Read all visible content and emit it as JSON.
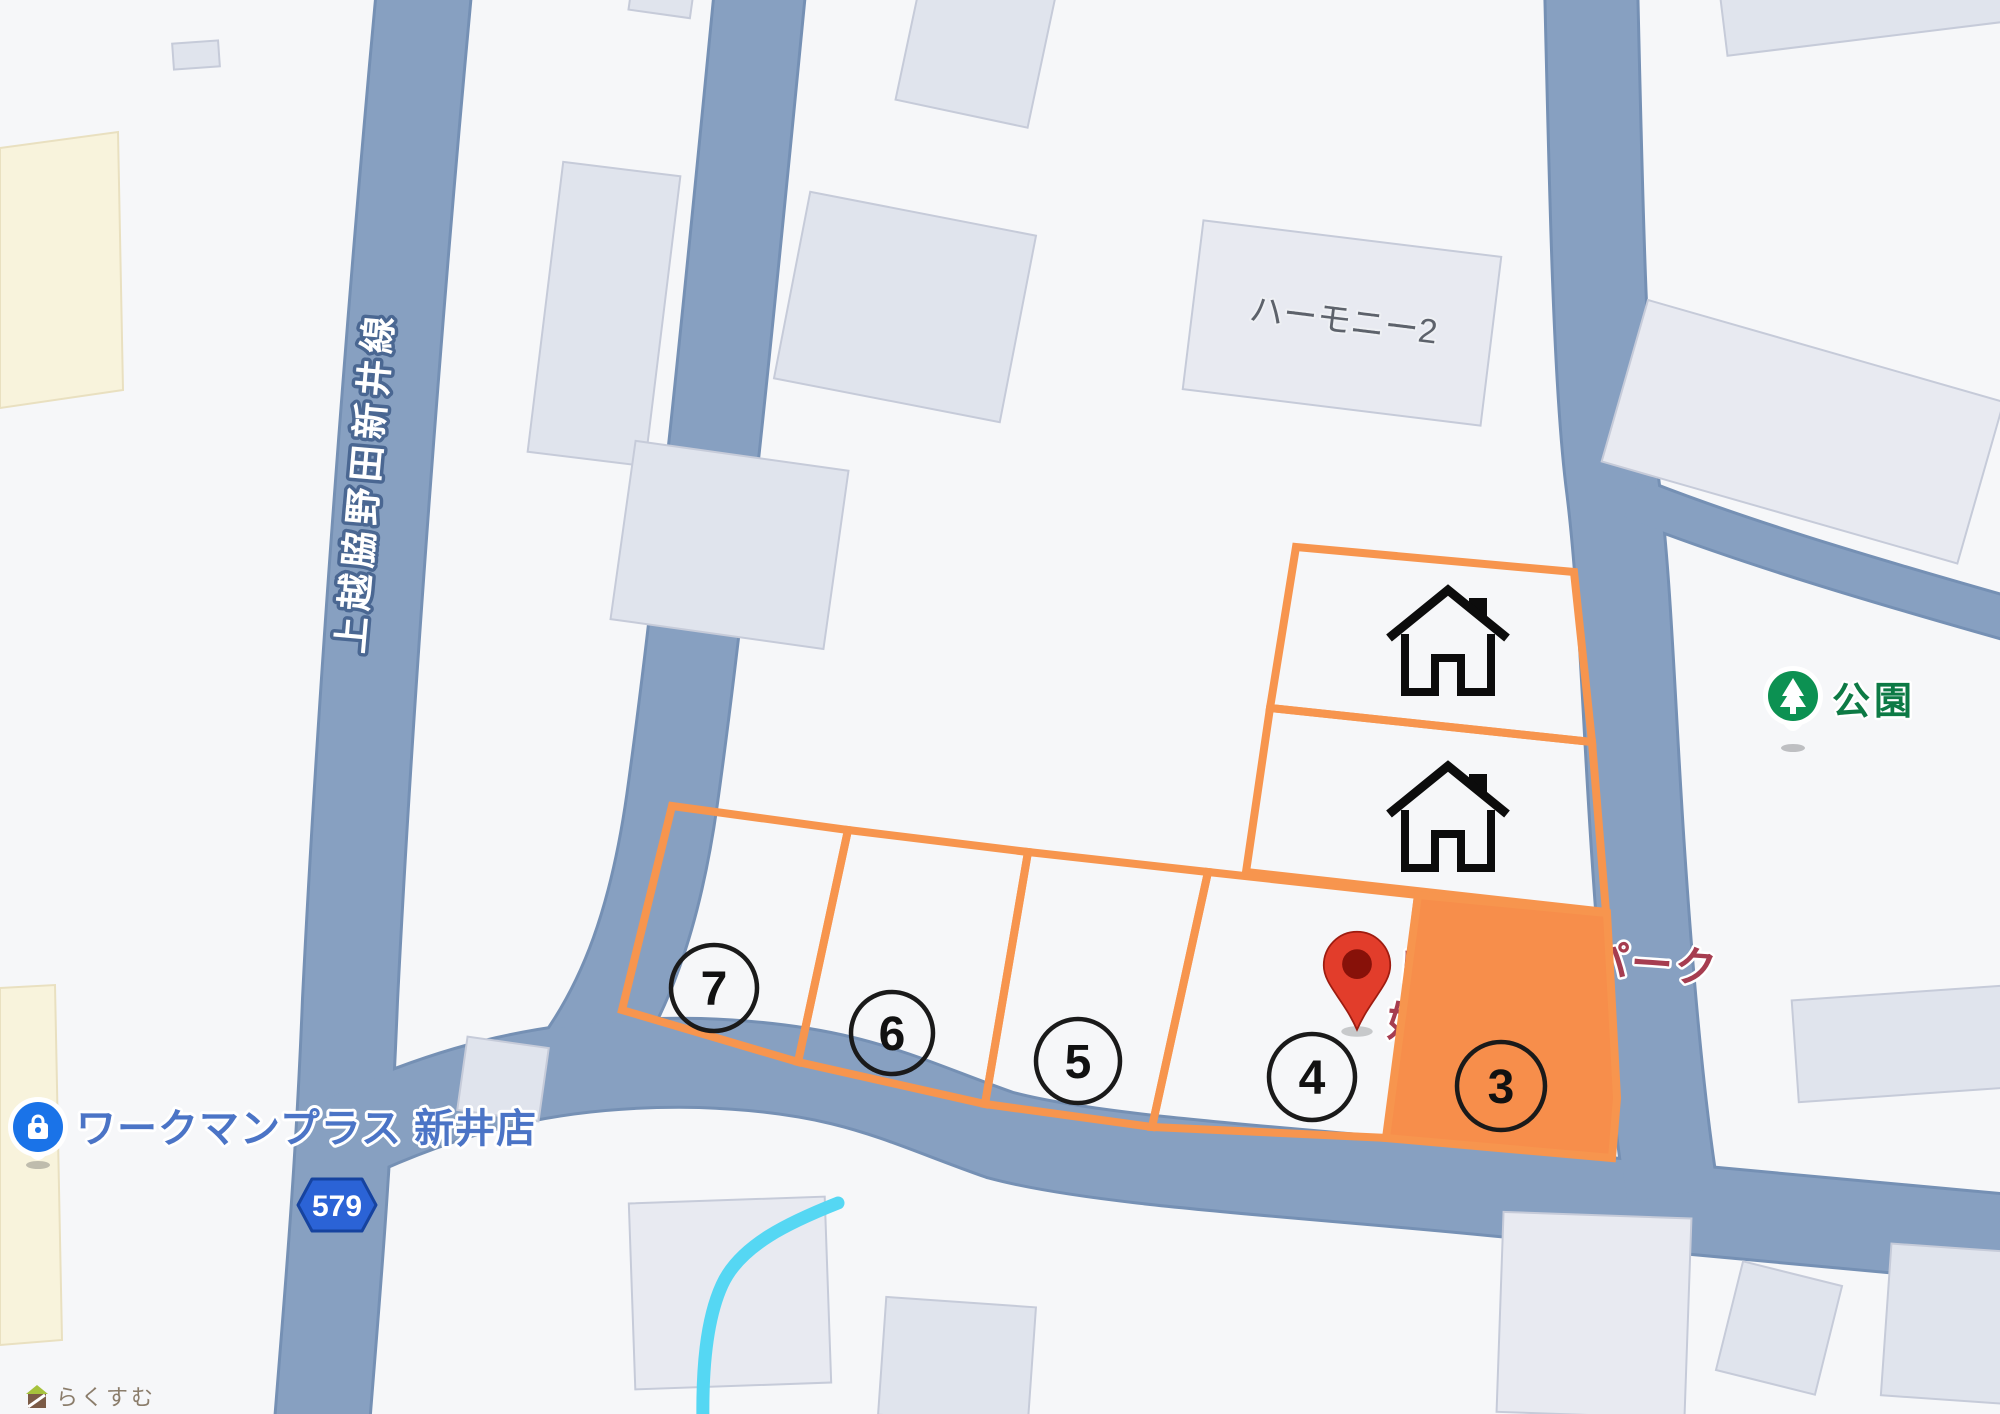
{
  "map_labels": {
    "road_name": "上越脇野田新井線",
    "route_number": "579",
    "building_name": "ハーモニー2",
    "park_name": "公園",
    "store_name": "ワークマンプラス 新井店",
    "place_name_fragment_left_1": "レ",
    "place_name_fragment_left_2": "妙",
    "place_name_fragment_right": "パーク",
    "watermark": "らくすむ"
  },
  "lots": {
    "items": [
      {
        "number": "3",
        "highlighted": true
      },
      {
        "number": "4",
        "highlighted": false
      },
      {
        "number": "5",
        "highlighted": false
      },
      {
        "number": "6",
        "highlighted": false
      },
      {
        "number": "7",
        "highlighted": false
      }
    ]
  },
  "icons": {
    "red_map_pin": "map-pin-icon",
    "house_1": "house-icon",
    "house_2": "house-icon",
    "park_pin": "park-tree-pin-icon",
    "store_pin": "store-bag-pin-icon",
    "watermark_house": "watermark-house-icon"
  },
  "colors": {
    "lot_outline": "#F7954E",
    "lot_fill": "#F78E4B",
    "road_fill": "#87A0C1",
    "road_casing": "#7590B4",
    "pin_red": "#E23D2B",
    "pin_red_dark": "#871109",
    "park_green": "#0C9152",
    "park_text_green": "#0D7A45",
    "store_blue": "#1A73E8",
    "store_text_blue": "#4B74C6",
    "shield_blue": "#2B63D6",
    "place_text_red": "#A63D50",
    "building_fill": "#E0E4ED",
    "beige_area": "#F8F3DC",
    "stream_cyan": "#55D7F3"
  }
}
